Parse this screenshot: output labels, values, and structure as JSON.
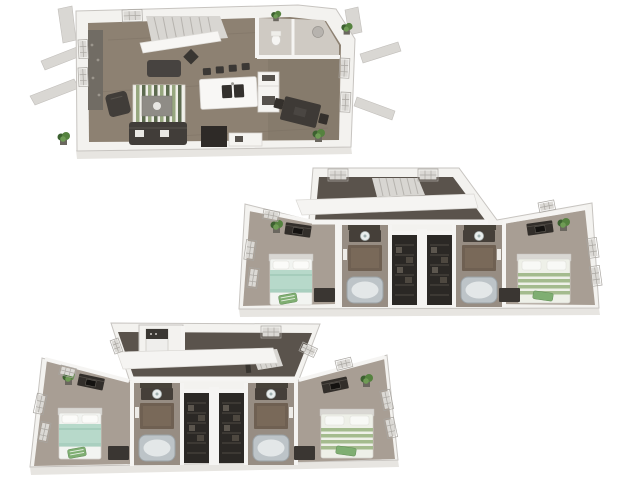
{
  "image": {
    "type": "3d-floorplan-rendering",
    "description": "Three stacked isometric 3D floor plan renderings of a three-level townhome floor plan on a white background",
    "background": "#ffffff"
  },
  "palette": {
    "background": "#ffffff",
    "wallTop": "#f3f2ef",
    "wallEdge": "#c7c4c0",
    "wallLine": "#f5f4f2",
    "frontFace": "#e7e5e1",
    "fin": "#d9d7d3",
    "finEdge": "#c1beba",
    "floorWood": "#8d8172",
    "floorWoodDark": "#776c5f",
    "smallRoomFloor": "#cfcac3",
    "carpet": "#a89e94",
    "bathFloor": "#978d83",
    "hallFloor": "#5a534c",
    "closetDark": "#2b2825",
    "closetShelf": "#4f4a44",
    "stair": "#d8d6d2",
    "stairEdge": "#b6b3ae",
    "accentWall": "#716c64",
    "rugWhite": "#f0efe9",
    "rugGreen": "#97a77f",
    "rugGreenDark": "#5d6b4f",
    "sofa": "#413d39",
    "furnDark": "#3a3632",
    "island": "#f8f7f5",
    "counterWhite": "#f5f4f1",
    "sink": "#34312e",
    "diningTable": "#3e3a36",
    "bedWhite": "#f2f4f1",
    "bedMint": "#b7d9ca",
    "bedMintDark": "#9cc6b3",
    "stripeWhite": "#eef0e8",
    "stripeGreen": "#a4bb8e",
    "throwGreen": "#7fae72",
    "tub": "#bdc4c8",
    "tubInner": "#e3e7e8",
    "vanityBrown": "#6f6052",
    "vanityDark": "#453f39",
    "dresser": "#322e2a",
    "plant": "#55823f",
    "plantDark": "#3c6130",
    "plantLight": "#6f9b55",
    "pot": "#6b675f",
    "windowFrame": "#fbfbfa",
    "windowGlass": "#dbd9d5",
    "windowGrid": "#a9a6a1",
    "appliance": "#efeeec",
    "applianceDark": "#3a3733",
    "mirrorDark": "#474239"
  },
  "floors": [
    {
      "id": "level-1-living-kitchen",
      "position": "top-left",
      "rooms": [
        "living-room",
        "kitchen",
        "dining-area",
        "staircase",
        "powder-room",
        "utility-room"
      ],
      "furniture": [
        "green-striped-area-rug",
        "sofa",
        "loveseat",
        "armchair",
        "coffee-table",
        "kitchen-island-with-double-sink",
        "bar-stools",
        "refrigerator-counter",
        "dining-table-with-chairs",
        "tv-console",
        "white-sideboard",
        "potted-plants"
      ],
      "exterior": [
        "roof-fins",
        "grid-windows",
        "plants"
      ]
    },
    {
      "id": "level-2-bedrooms",
      "position": "middle-right",
      "rooms": [
        "stair-landing",
        "bedroom-left",
        "bathroom-left",
        "walk-in-closet-left",
        "walk-in-closet-right",
        "bathroom-right",
        "bedroom-right"
      ],
      "furniture": [
        "mint-green-bed",
        "green-striped-bed",
        "media-dressers",
        "desks",
        "vessel-sink-vanities",
        "bathtubs",
        "closet-shelving",
        "potted-plants"
      ],
      "exterior": [
        "grid-windows"
      ]
    },
    {
      "id": "level-3-bedrooms-laundry",
      "position": "bottom-left",
      "rooms": [
        "hallway",
        "laundry-closet",
        "stair-landing",
        "bedroom-left",
        "bathroom-left",
        "walk-in-closet-left",
        "walk-in-closet-right",
        "bathroom-right",
        "bedroom-right"
      ],
      "furniture": [
        "stacked-washer-dryer",
        "mint-green-bed",
        "green-striped-bed",
        "media-dressers",
        "desks",
        "vessel-sink-vanities",
        "bathtubs",
        "closet-shelving",
        "potted-plants"
      ],
      "exterior": [
        "grid-windows"
      ]
    }
  ]
}
